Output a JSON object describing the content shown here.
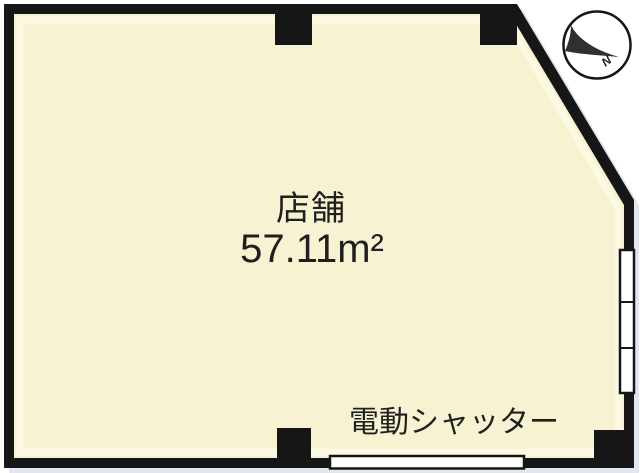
{
  "floor_plan": {
    "room": {
      "name_label": "店舗",
      "area_label": "57.11m²"
    },
    "shutter_label": "電動シャッター",
    "compass": {
      "north_label": "N"
    },
    "colors": {
      "wall": "#161616",
      "floor": "#f7f3d2",
      "floor_highlight": "#fbf9e6",
      "shadow": "#c9d2e2",
      "opening_fill": "#ffffff",
      "compass_arrow": "#303030",
      "text": "#1f1f1f"
    }
  }
}
